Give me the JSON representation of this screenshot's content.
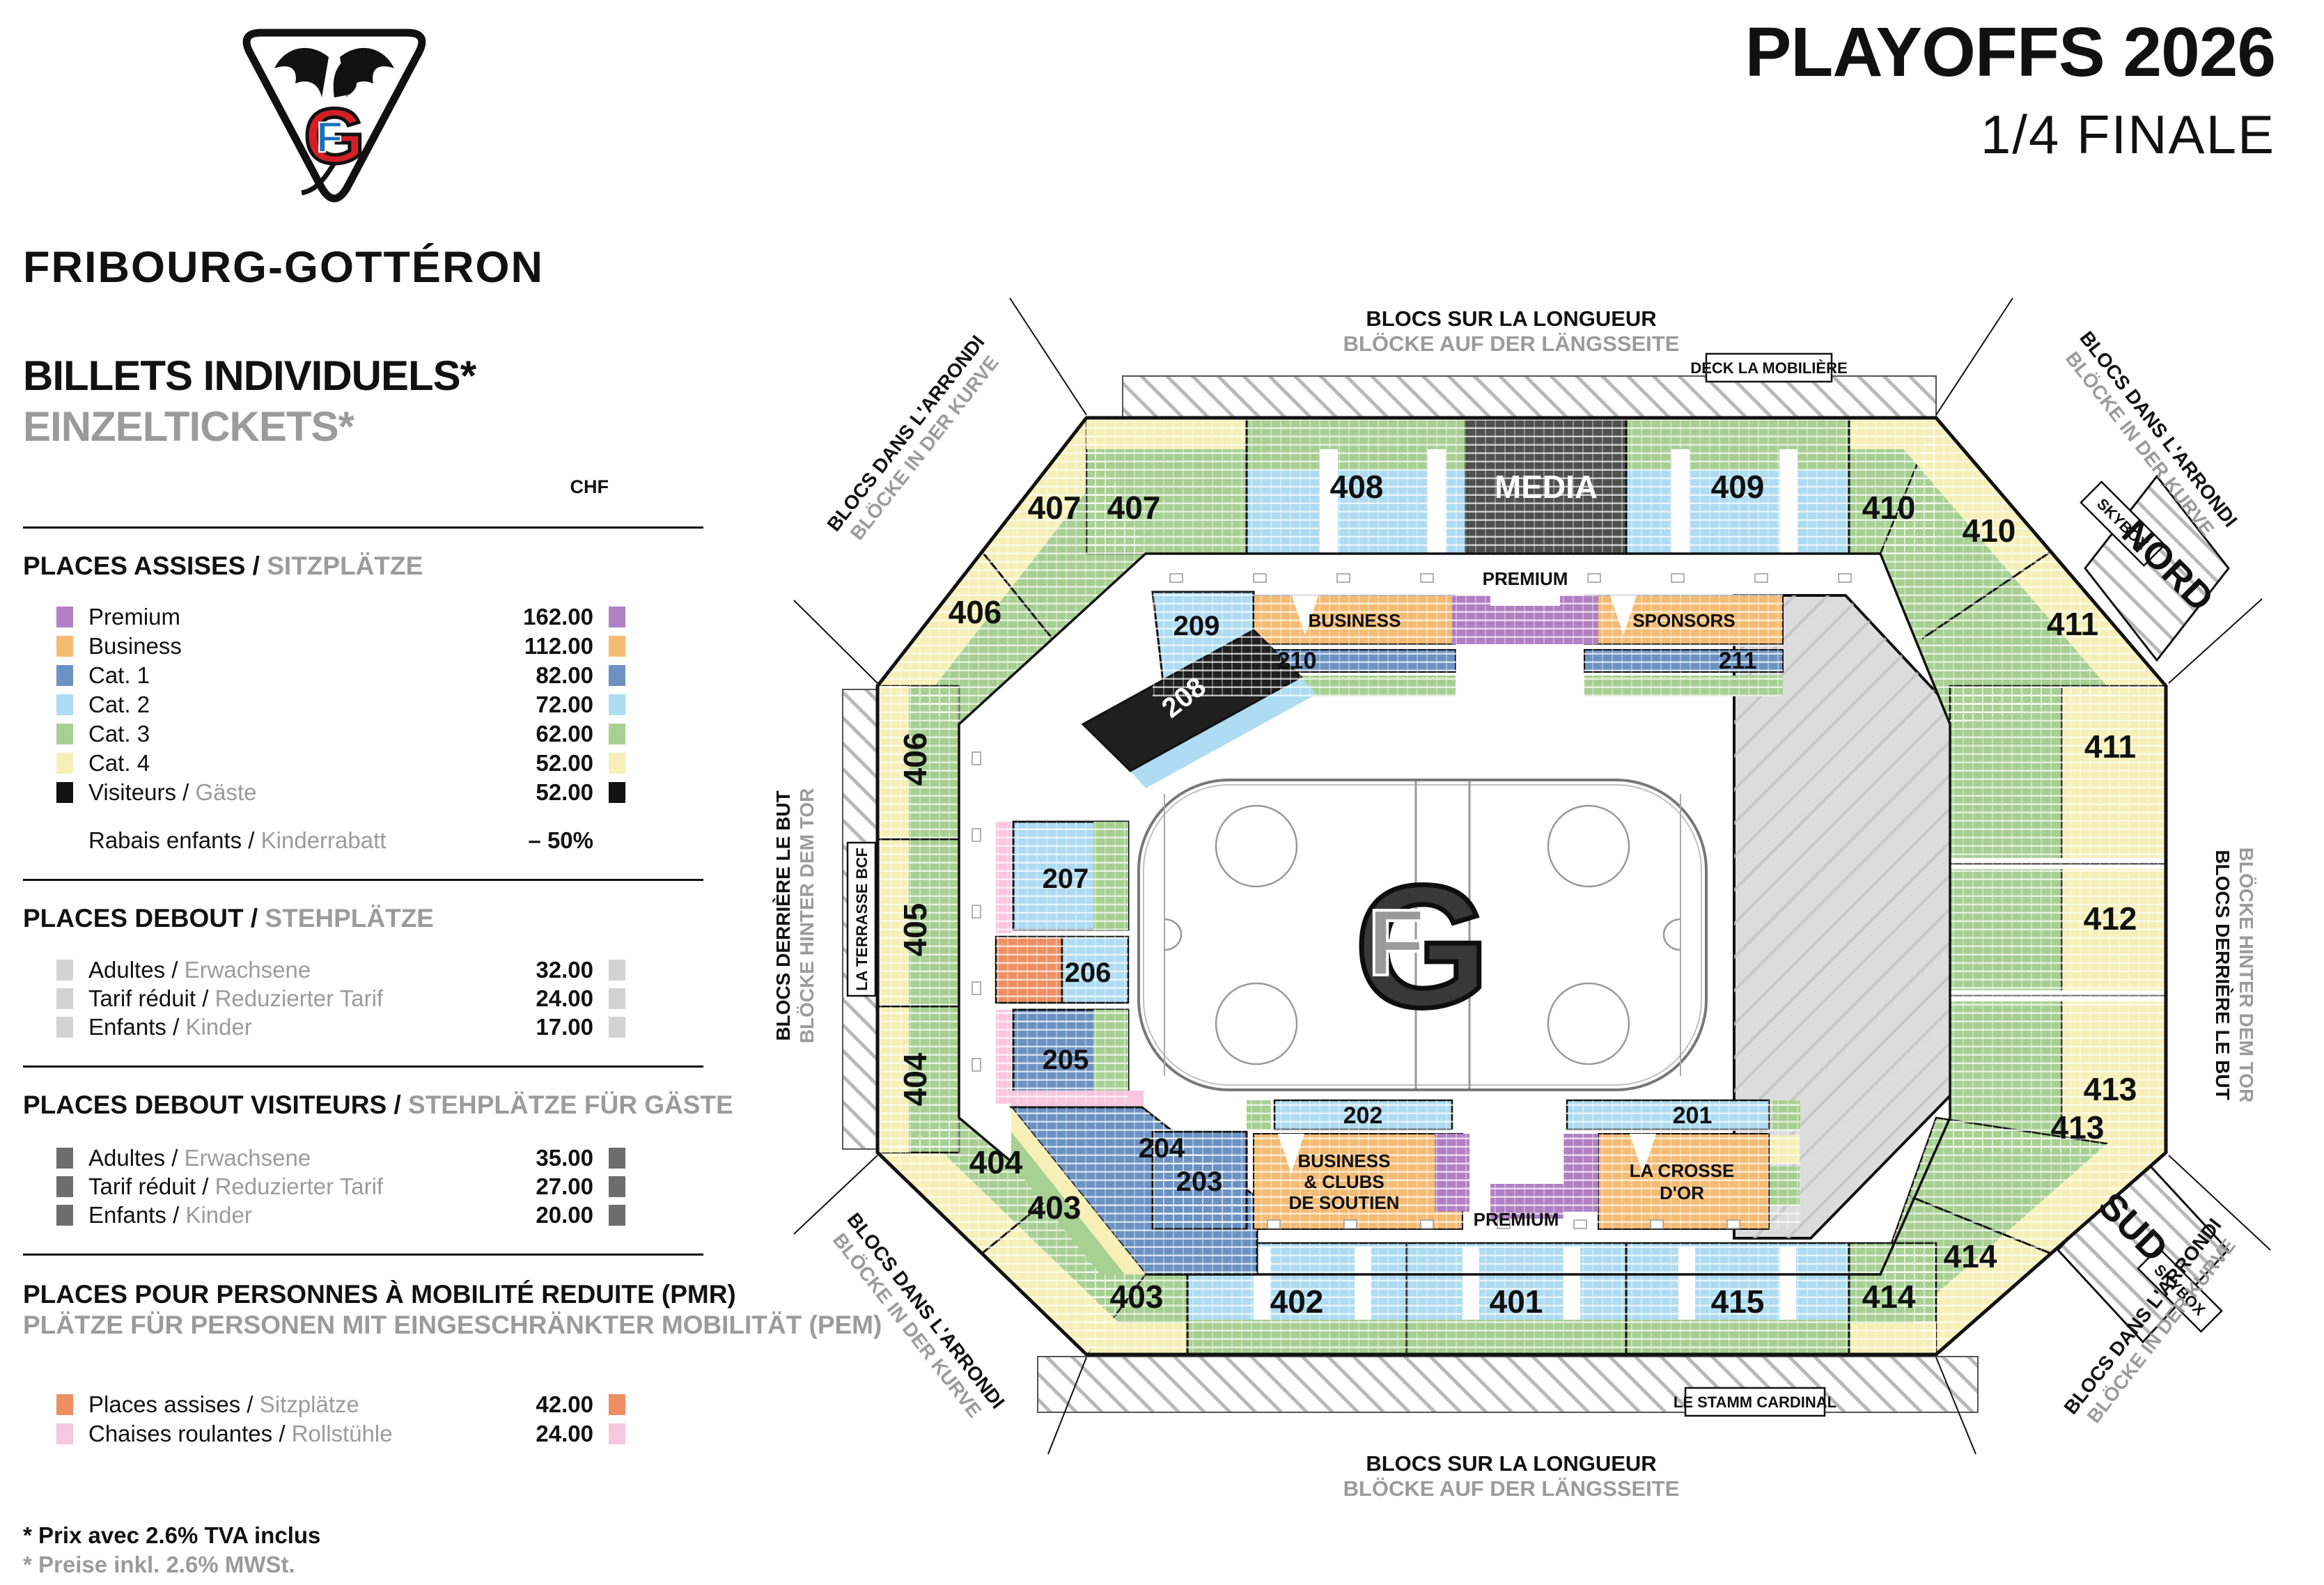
{
  "header": {
    "title": "PLAYOFFS 2026",
    "subtitle": "1/4 FINALE"
  },
  "brand": {
    "team": "FRIBOURG-GOTTÉRON",
    "monogram_g": "G",
    "monogram_f": "F"
  },
  "pricing": {
    "title_fr": "BILLETS INDIVIDUELS*",
    "title_de": "EINZELTICKETS*",
    "currency": "CHF",
    "sections": [
      {
        "heading_fr": "PLACES ASSISES",
        "heading_de": "SITZPLÄTZE",
        "rows": [
          {
            "label_fr": "Premium",
            "label_de": "",
            "price": "162.00",
            "ckey": "premium"
          },
          {
            "label_fr": "Business",
            "label_de": "",
            "price": "112.00",
            "ckey": "business"
          },
          {
            "label_fr": "Cat. 1",
            "label_de": "",
            "price": "82.00",
            "ckey": "cat1"
          },
          {
            "label_fr": "Cat. 2",
            "label_de": "",
            "price": "72.00",
            "ckey": "cat2"
          },
          {
            "label_fr": "Cat. 3",
            "label_de": "",
            "price": "62.00",
            "ckey": "cat3"
          },
          {
            "label_fr": "Cat. 4",
            "label_de": "",
            "price": "52.00",
            "ckey": "cat4"
          },
          {
            "label_fr": "Visiteurs",
            "label_de": "Gäste",
            "price": "52.00",
            "ckey": "visitors"
          }
        ],
        "extra": {
          "label_fr": "Rabais enfants",
          "label_de": "Kinderrabatt",
          "price": "– 50%"
        }
      },
      {
        "heading_fr": "PLACES DEBOUT",
        "heading_de": "STEHPLÄTZE",
        "rows": [
          {
            "label_fr": "Adultes",
            "label_de": "Erwachsene",
            "price": "32.00",
            "ckey": "standing"
          },
          {
            "label_fr": "Tarif réduit",
            "label_de": "Reduzierter Tarif",
            "price": "24.00",
            "ckey": "standing"
          },
          {
            "label_fr": "Enfants",
            "label_de": "Kinder",
            "price": "17.00",
            "ckey": "standing"
          }
        ]
      },
      {
        "heading_fr": "PLACES DEBOUT VISITEURS",
        "heading_de": "STEHPLÄTZE FÜR GÄSTE",
        "rows": [
          {
            "label_fr": "Adultes",
            "label_de": "Erwachsene",
            "price": "35.00",
            "ckey": "standing_visitors"
          },
          {
            "label_fr": "Tarif réduit",
            "label_de": "Reduzierter Tarif",
            "price": "27.00",
            "ckey": "standing_visitors"
          },
          {
            "label_fr": "Enfants",
            "label_de": "Kinder",
            "price": "20.00",
            "ckey": "standing_visitors"
          }
        ]
      },
      {
        "heading_fr": "PLACES POUR PERSONNES À MOBILITÉ REDUITE (PMR)",
        "heading_de": "PLÄTZE FÜR PERSONEN MIT EINGESCHRÄNKTER MOBILITÄT (PEM)",
        "rows": [
          {
            "label_fr": "Places assises",
            "label_de": "Sitzplätze",
            "price": "42.00",
            "ckey": "pmr_seat"
          },
          {
            "label_fr": "Chaises roulantes",
            "label_de": "Rollstühle",
            "price": "24.00",
            "ckey": "wheelchair"
          }
        ]
      }
    ],
    "footnote_fr": "* Prix avec 2.6% TVA inclus",
    "footnote_de": "* Preise inkl. 2.6% MWSt."
  },
  "map": {
    "blocs_longueur_fr": "BLOCS SUR LA LONGUEUR",
    "blocs_longueur_de": "BLÖCKE AUF DER LÄNGSSEITE",
    "blocs_arrondi_fr": "BLOCS DANS L'ARRONDI",
    "blocs_arrondi_de": "BLÖCKE IN DER KURVE",
    "blocs_but_fr": "BLOCS DERRIÈRE LE BUT",
    "blocs_but_de": "BLÖCKE HINTER DEM TOR",
    "deck": "DECK LA MOBILIÈRE",
    "stamm": "LE STAMM CARDINAL",
    "terrasse": "LA TERRASSE BCF",
    "dine": "DINE & VIEW",
    "skybox": "SKYBOX",
    "nord": "NORD",
    "sud": "SUD",
    "media": "MEDIA",
    "premium": "PREMIUM",
    "business": "BUSINESS",
    "sponsors": "SPONSORS",
    "business_clubs_1": "BUSINESS",
    "business_clubs_2": "& CLUBS",
    "business_clubs_3": "DE SOUTIEN",
    "crosse_1": "LA CROSSE",
    "crosse_2": "D'OR",
    "sections": {
      "s201": "201",
      "s202": "202",
      "s203": "203",
      "s204": "204",
      "s205": "205",
      "s206": "206",
      "s207": "207",
      "s208": "208",
      "s209": "209",
      "s210": "210",
      "s211": "211",
      "s401": "401",
      "s402": "402",
      "s403": "403",
      "s404": "404",
      "s405": "405",
      "s406": "406",
      "s407": "407",
      "s408": "408",
      "s409": "409",
      "s410": "410",
      "s411": "411",
      "s412": "412",
      "s413": "413",
      "s414": "414",
      "s415": "415"
    }
  },
  "colors": {
    "premium": "#b17fc4",
    "business": "#f5bb73",
    "cat1": "#6b92c3",
    "cat2": "#aedcf2",
    "cat3": "#a7d092",
    "cat4": "#f6f0b8",
    "visitors": "#121212",
    "standing": "#d3d3d3",
    "standing_visitors": "#6d6d6d",
    "pmr_seat": "#ee8f63",
    "wheelchair": "#f6c7de",
    "media_block": "#4f4f4f",
    "visitors_block": "#1f1f1f",
    "terrace": "#dcdcdc",
    "accent_red": "#d22027",
    "accent_blue": "#1d6fb8"
  }
}
